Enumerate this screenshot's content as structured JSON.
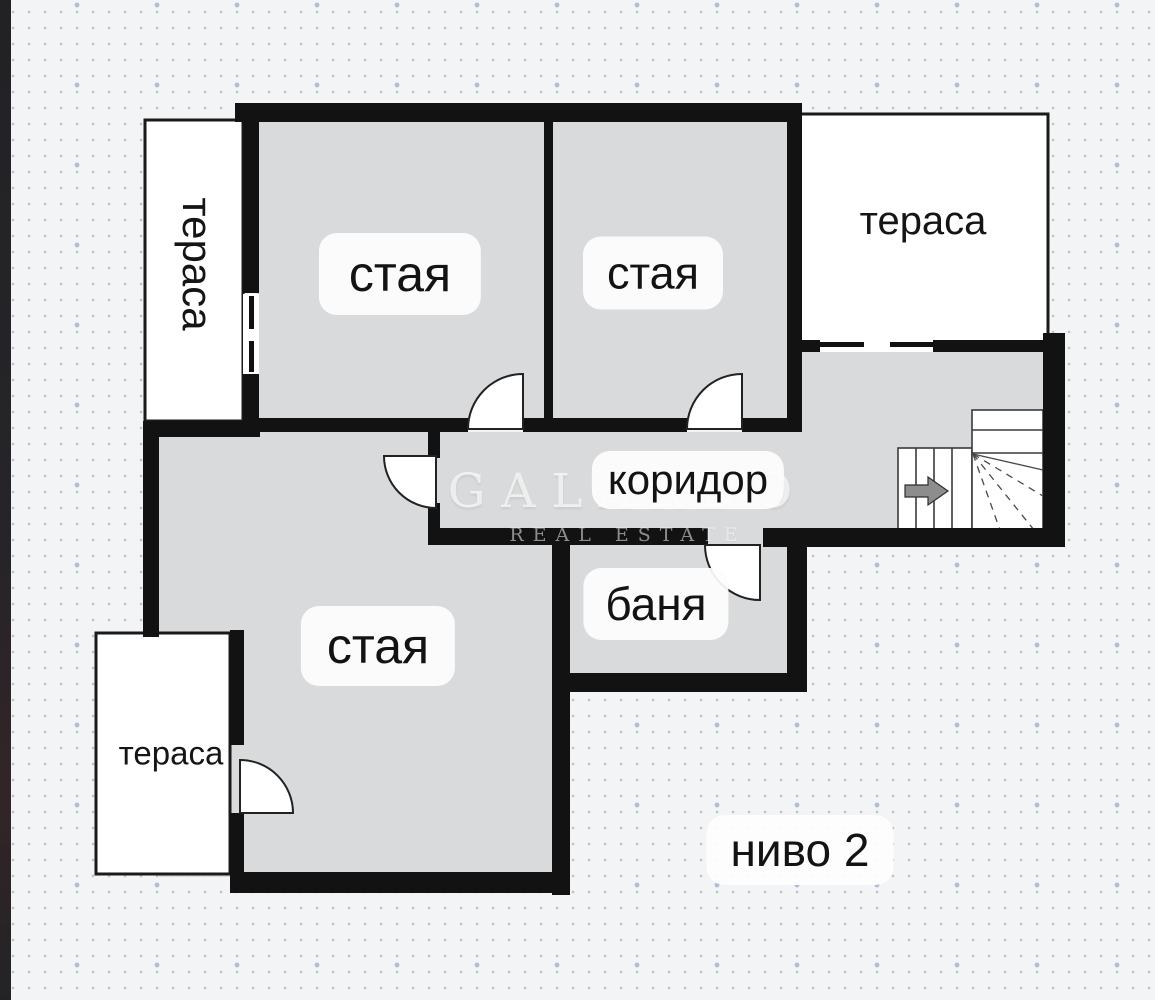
{
  "floor_plan": {
    "level_label": "ниво 2",
    "watermark": {
      "line1": "GALARDO",
      "line2": "REAL ESTATE"
    },
    "labels": {
      "room_top_left": "стая",
      "room_top_right": "стая",
      "room_bottom": "стая",
      "corridor": "коридор",
      "bathroom": "баня",
      "terrace_top_left": "тераса",
      "terrace_top_right": "тераса",
      "terrace_bottom_left": "тераса"
    },
    "icons": {
      "stairs_direction": "arrow-right-icon"
    },
    "colors": {
      "wall": "#121212",
      "interior": "#d9dadb",
      "terrace": "#ffffff",
      "background": "#f3f4f6",
      "grid_dot": "#78808e",
      "accent_dot": "#a3b7d8",
      "stair_arrow": "#8d8d8d",
      "label_text": "#131313"
    }
  }
}
